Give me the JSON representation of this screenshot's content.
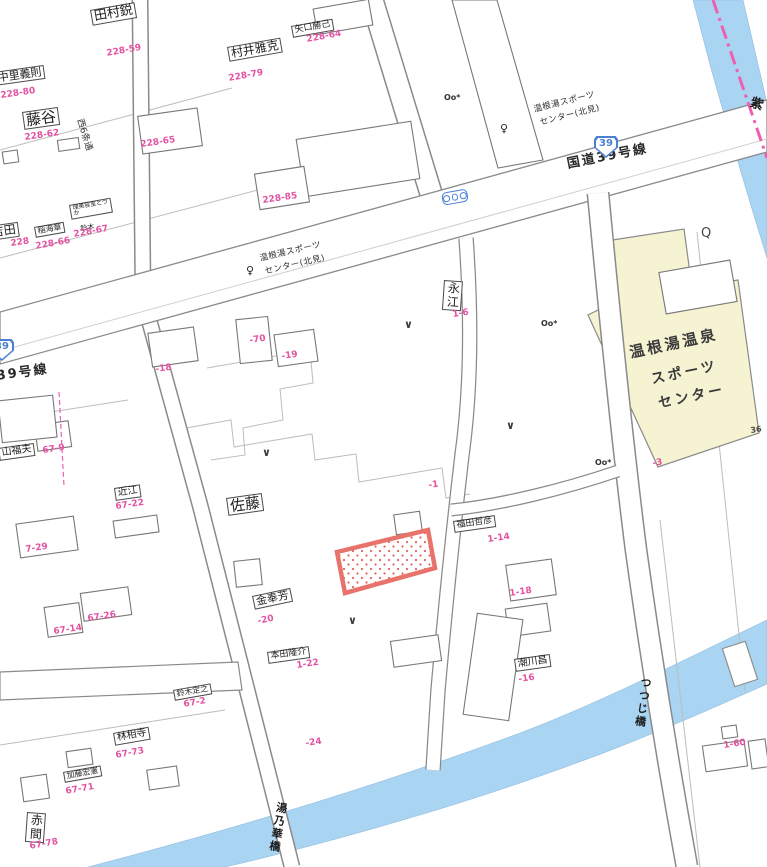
{
  "meta": {
    "description": "Japanese residential cadastral map, Onneyu hot-spring district, Route 39"
  },
  "colors": {
    "ink": "#1f1f1f",
    "pink_label": "#e353a2",
    "route_blue": "#4a7fd4",
    "river_blue": "#a9d4f2",
    "road_outline": "#8a8a8a",
    "yellow_building": "#f6f3d3",
    "highlight_red": "#e8736a",
    "boundary_pink": "#ee5fb0"
  },
  "labels": [
    {
      "t": "田村鋭",
      "k": "nb",
      "x": 90,
      "y": 10,
      "r": -10,
      "fs": 13
    },
    {
      "t": "228-59",
      "k": "pk",
      "x": 106,
      "y": 50,
      "r": -10
    },
    {
      "t": "中里義則",
      "k": "nb",
      "x": -6,
      "y": 72,
      "r": -8,
      "fs": 11
    },
    {
      "t": "228-80",
      "k": "pk",
      "x": 0,
      "y": 92,
      "r": -8
    },
    {
      "t": "藤谷",
      "k": "nb",
      "x": 22,
      "y": 112,
      "r": -8,
      "fs": 15
    },
    {
      "t": "228-62",
      "k": "pk",
      "x": 24,
      "y": 134,
      "r": -8
    },
    {
      "t": "村井雅克",
      "k": "nb",
      "x": 227,
      "y": 47,
      "r": -10,
      "fs": 12
    },
    {
      "t": "228-79",
      "k": "pk",
      "x": 228,
      "y": 75,
      "r": -10
    },
    {
      "t": "矢口勝己",
      "k": "nb",
      "x": 291,
      "y": 26,
      "r": -10,
      "fs": 9
    },
    {
      "t": "228-64",
      "k": "pk",
      "x": 306,
      "y": 36,
      "r": -10
    },
    {
      "t": "228-65",
      "k": "pk",
      "x": 140,
      "y": 141,
      "r": -8
    },
    {
      "t": "228-85",
      "k": "pk",
      "x": 262,
      "y": 197,
      "r": -8
    },
    {
      "t": "吉田",
      "k": "nb",
      "x": -12,
      "y": 226,
      "r": -8,
      "fs": 12
    },
    {
      "t": "228",
      "k": "pk",
      "x": 10,
      "y": 240,
      "r": -8
    },
    {
      "t": "稲海章",
      "k": "nb",
      "x": 34,
      "y": 227,
      "r": -10,
      "fs": 8
    },
    {
      "t": "228-66",
      "k": "pk",
      "x": 35,
      "y": 243,
      "r": -10
    },
    {
      "t": "理美容室とづか",
      "k": "nb",
      "x": 69,
      "y": 205,
      "r": -10,
      "fs": 6,
      "w": 36
    },
    {
      "t": "鈴木",
      "k": "nm",
      "x": 80,
      "y": 226,
      "r": -10,
      "fs": 7
    },
    {
      "t": "228-67",
      "k": "pk",
      "x": 73,
      "y": 231,
      "r": -10
    },
    {
      "t": "西6条通",
      "k": "st",
      "x": 83,
      "y": 118,
      "r": 73,
      "fs": 9
    },
    {
      "t": "39号線",
      "k": "rd",
      "x": -4,
      "y": 370,
      "r": -8,
      "fs": 13
    },
    {
      "t": "国道39号線",
      "k": "rd",
      "x": 566,
      "y": 158,
      "r": -11,
      "fs": 13
    },
    {
      "t": "温根湯スポーツ",
      "k": "bs",
      "x": 259,
      "y": 255,
      "r": -13
    },
    {
      "t": "センター(北見)",
      "k": "bs",
      "x": 264,
      "y": 268,
      "r": -13
    },
    {
      "t": "温根湯スポーツ",
      "k": "bs",
      "x": 533,
      "y": 106,
      "r": -14
    },
    {
      "t": "センター(北見)",
      "k": "bs",
      "x": 539,
      "y": 119,
      "r": -14
    },
    {
      "t": "永江",
      "k": "nb",
      "x": 444,
      "y": 280,
      "r": 4,
      "fs": 12,
      "v": 1
    },
    {
      "t": "1-6",
      "k": "pk",
      "x": 452,
      "y": 311,
      "r": -8
    },
    {
      "t": "-70",
      "k": "pk",
      "x": 249,
      "y": 337,
      "r": -8
    },
    {
      "t": "-18",
      "k": "pk",
      "x": 155,
      "y": 366,
      "r": -8
    },
    {
      "t": "-19",
      "k": "pk",
      "x": 281,
      "y": 353,
      "r": -8
    },
    {
      "t": "温根湯温泉",
      "k": "fc",
      "x": 628,
      "y": 345,
      "r": -12,
      "fs": 15
    },
    {
      "t": "スポーツ",
      "k": "fc",
      "x": 650,
      "y": 373,
      "r": -12,
      "fs": 14
    },
    {
      "t": "センター",
      "k": "fc",
      "x": 657,
      "y": 397,
      "r": -12,
      "fs": 14
    },
    {
      "t": "-3",
      "k": "pk",
      "x": 652,
      "y": 460,
      "r": -8
    },
    {
      "t": "36",
      "k": "dk",
      "x": 750,
      "y": 427,
      "r": -8
    },
    {
      "t": "佐藤",
      "k": "nb",
      "x": 226,
      "y": 498,
      "r": -8,
      "fs": 15
    },
    {
      "t": "-1",
      "k": "pk",
      "x": 428,
      "y": 482,
      "r": -8
    },
    {
      "t": "福田哲彦",
      "k": "nb",
      "x": 453,
      "y": 521,
      "r": -8,
      "fs": 9
    },
    {
      "t": "1-14",
      "k": "pk",
      "x": 487,
      "y": 536,
      "r": -8
    },
    {
      "t": "1-18",
      "k": "pk",
      "x": 509,
      "y": 590,
      "r": -8
    },
    {
      "t": "金奉芳",
      "k": "nb",
      "x": 252,
      "y": 596,
      "r": -12,
      "fs": 11
    },
    {
      "t": "-20",
      "k": "pk",
      "x": 257,
      "y": 618,
      "r": -12
    },
    {
      "t": "本田隆介",
      "k": "nb",
      "x": 267,
      "y": 652,
      "r": -8,
      "fs": 9
    },
    {
      "t": "1-22",
      "k": "pk",
      "x": 296,
      "y": 662,
      "r": -8
    },
    {
      "t": "潮川昌",
      "k": "nb",
      "x": 514,
      "y": 659,
      "r": -8,
      "fs": 10
    },
    {
      "t": "-16",
      "k": "pk",
      "x": 518,
      "y": 676,
      "r": -8
    },
    {
      "t": "-24",
      "k": "pk",
      "x": 305,
      "y": 740,
      "r": -8
    },
    {
      "t": "山福夫",
      "k": "nb",
      "x": -2,
      "y": 448,
      "r": -8,
      "fs": 10
    },
    {
      "t": "67-9",
      "k": "pk",
      "x": 42,
      "y": 447,
      "r": -8
    },
    {
      "t": "近江",
      "k": "nb",
      "x": 114,
      "y": 488,
      "r": -8,
      "fs": 10
    },
    {
      "t": "67-22",
      "k": "pk",
      "x": 115,
      "y": 503,
      "r": -8
    },
    {
      "t": "7-29",
      "k": "pk",
      "x": 25,
      "y": 546,
      "r": -8
    },
    {
      "t": "67-14",
      "k": "pk",
      "x": 53,
      "y": 628,
      "r": -8
    },
    {
      "t": "67-26",
      "k": "pk",
      "x": 87,
      "y": 615,
      "r": -8
    },
    {
      "t": "鈴木定之",
      "k": "nb",
      "x": 173,
      "y": 690,
      "r": -10,
      "fs": 8
    },
    {
      "t": "67-2",
      "k": "pk",
      "x": 183,
      "y": 701,
      "r": -10
    },
    {
      "t": "林相寺",
      "k": "nb",
      "x": 113,
      "y": 733,
      "r": -10,
      "fs": 10
    },
    {
      "t": "67-73",
      "k": "pk",
      "x": 115,
      "y": 752,
      "r": -10
    },
    {
      "t": "加藤宏憲",
      "k": "nb",
      "x": 63,
      "y": 772,
      "r": -10,
      "fs": 8
    },
    {
      "t": "67-71",
      "k": "pk",
      "x": 65,
      "y": 788,
      "r": -10
    },
    {
      "t": "赤間",
      "k": "nb",
      "x": 27,
      "y": 812,
      "r": 4,
      "fs": 12,
      "v": 1
    },
    {
      "t": "67-78",
      "k": "pk",
      "x": 29,
      "y": 843,
      "r": -10
    },
    {
      "t": "1-60",
      "k": "pk",
      "x": 723,
      "y": 742,
      "r": -8
    },
    {
      "t": "つつじ橋",
      "k": "br",
      "x": 640,
      "y": 676,
      "r": 8,
      "fs": 11,
      "v": 1
    },
    {
      "t": "湯乃華橋",
      "k": "br",
      "x": 276,
      "y": 801,
      "r": 10,
      "fs": 11,
      "v": 1
    },
    {
      "t": "紫",
      "k": "br",
      "x": 750,
      "y": 94,
      "r": 18,
      "fs": 13,
      "v": 1
    }
  ],
  "symbols": [
    {
      "type": "bus-stop",
      "glyph": "♀",
      "x": 246,
      "y": 264
    },
    {
      "type": "bus-stop",
      "glyph": "♀",
      "x": 500,
      "y": 122
    },
    {
      "type": "route-shield",
      "label": "39",
      "x": 594,
      "y": 136
    },
    {
      "type": "route-shield",
      "label": "39",
      "x": -10,
      "y": 339
    },
    {
      "type": "traffic-light",
      "x": 441,
      "y": 193,
      "r": -10
    },
    {
      "type": "utility-pole",
      "glyph": "Oo*",
      "x": 444,
      "y": 93
    },
    {
      "type": "utility-pole",
      "glyph": "Oo*",
      "x": 541,
      "y": 319
    },
    {
      "type": "utility-pole",
      "glyph": "Oo*",
      "x": 595,
      "y": 458
    },
    {
      "type": "well",
      "glyph": "Q",
      "x": 701,
      "y": 226
    },
    {
      "type": "entrance",
      "glyph": "∨",
      "x": 404,
      "y": 318
    },
    {
      "type": "entrance",
      "glyph": "∨",
      "x": 262,
      "y": 446
    },
    {
      "type": "entrance",
      "glyph": "∨",
      "x": 348,
      "y": 614
    },
    {
      "type": "entrance",
      "glyph": "∨",
      "x": 506,
      "y": 419
    }
  ]
}
